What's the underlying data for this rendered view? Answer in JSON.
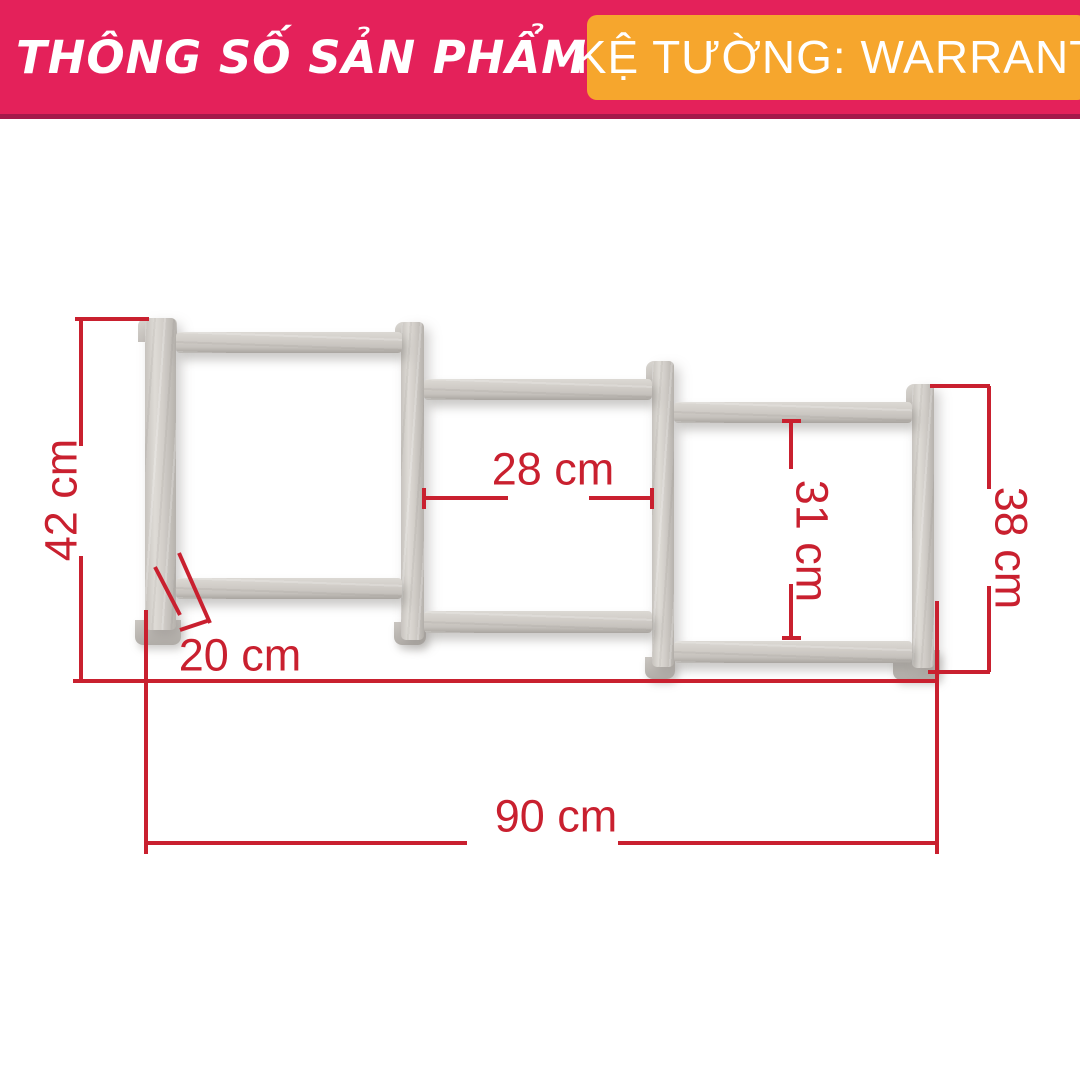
{
  "header": {
    "title": "THÔNG SỐ SẢN PHẨM",
    "product_label": "KỆ TƯỜNG: WARRANT",
    "colors": {
      "banner": "#e4215a",
      "banner_edge": "#a5194a",
      "badge": "#f6a62d",
      "text": "#ffffff"
    }
  },
  "diagram": {
    "subject": "wall-shelf-dimension-drawing",
    "accent_color": "#c9202f",
    "wood_colors": {
      "light": "#dedbd6",
      "mid": "#d0ccc7",
      "dark": "#b1ada8"
    },
    "dimensions": {
      "height_left": {
        "label": "42 cm",
        "value_cm": 42
      },
      "width_middle": {
        "label": "28 cm",
        "value_cm": 28
      },
      "height_right_inner": {
        "label": "31 cm",
        "value_cm": 31
      },
      "height_right": {
        "label": "38 cm",
        "value_cm": 38
      },
      "depth": {
        "label": "20 cm",
        "value_cm": 20
      },
      "width_total": {
        "label": "90 cm",
        "value_cm": 90
      }
    }
  }
}
